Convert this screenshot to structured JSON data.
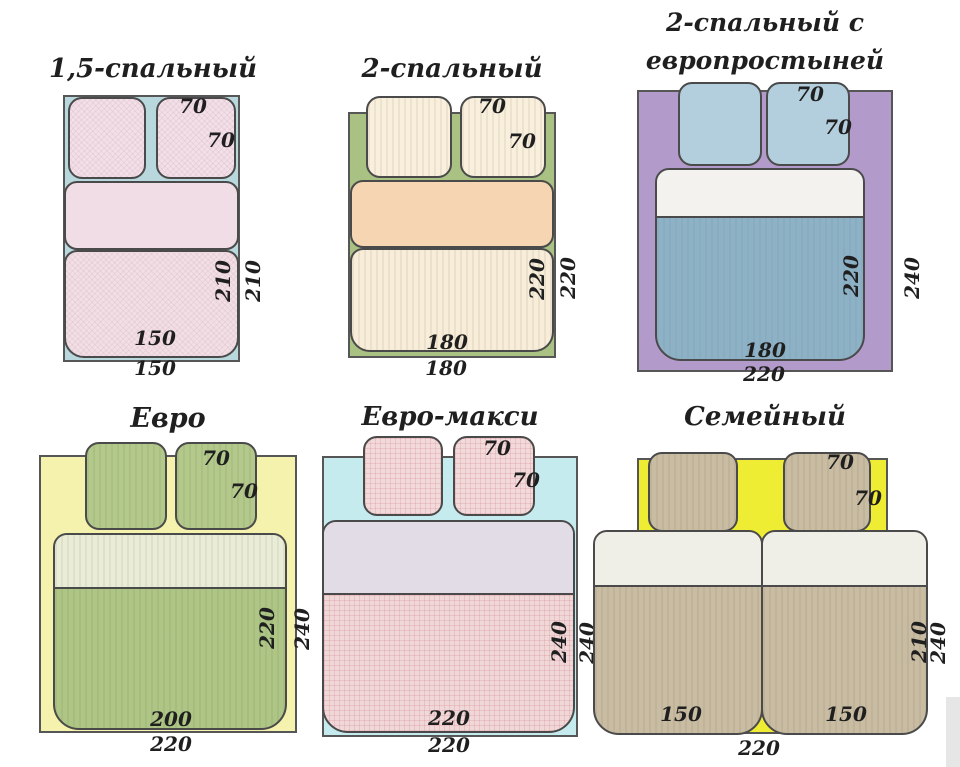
{
  "page": {
    "bg": "#ffffff",
    "ink": "#1f1f1f"
  },
  "panels": [
    {
      "title": "1,5-спальный",
      "labels": {
        "pillow_top": "70",
        "pillow_side": "70",
        "inner_h": "210",
        "outer_h": "210",
        "inner_w": "150",
        "outer_w": "150"
      },
      "colors": {
        "sheet": "#b9d8de",
        "pillow": "#f2dfe7",
        "band": "#f1dde6",
        "body": "#f2dfe5"
      }
    },
    {
      "title": "2-спальный",
      "labels": {
        "pillow_top": "70",
        "pillow_side": "70",
        "inner_h": "220",
        "outer_h": "220",
        "inner_w": "180",
        "outer_w": "180"
      },
      "colors": {
        "sheet": "#a9c183",
        "pillow": "#f8efdc",
        "band": "#f6d6b2",
        "body": "#f7edd8"
      }
    },
    {
      "title_line1": "2-спальный с",
      "title_line2": "европростыней",
      "labels": {
        "pillow_top": "70",
        "pillow_side": "70",
        "inner_h": "220",
        "outer_h": "240",
        "inner_w": "180",
        "outer_w": "220"
      },
      "colors": {
        "sheet": "#b29aca",
        "pillow": "#b3cedd",
        "band": "#f3f2ee",
        "body": "#8db1c5"
      }
    },
    {
      "title": "Евро",
      "labels": {
        "pillow_top": "70",
        "pillow_side": "70",
        "inner_h": "220",
        "outer_h": "240",
        "inner_w": "200",
        "outer_w": "220"
      },
      "colors": {
        "sheet": "#f4f2ac",
        "pillow": "#b3c98b",
        "band": "#e9ecd7",
        "body": "#aec685"
      }
    },
    {
      "title": "Евро-макси",
      "labels": {
        "pillow_top": "70",
        "pillow_side": "70",
        "inner_h": "240",
        "outer_h": "240",
        "inner_w": "220",
        "outer_w": "220"
      },
      "colors": {
        "sheet": "#c6ebee",
        "pillow": "#f2dada",
        "band": "#e2dce6",
        "body": "#f0d8d8"
      }
    },
    {
      "title": "Семейный",
      "labels": {
        "pillow_top": "70",
        "pillow_side": "70",
        "inner_h": "210",
        "outer_h": "240",
        "inner_w_left": "150",
        "inner_w_right": "150",
        "outer_w": "220"
      },
      "colors": {
        "sheet": "#efed33",
        "pillow": "#c8bca2",
        "band": "#f0efe7",
        "body": "#c8bca2"
      }
    }
  ]
}
